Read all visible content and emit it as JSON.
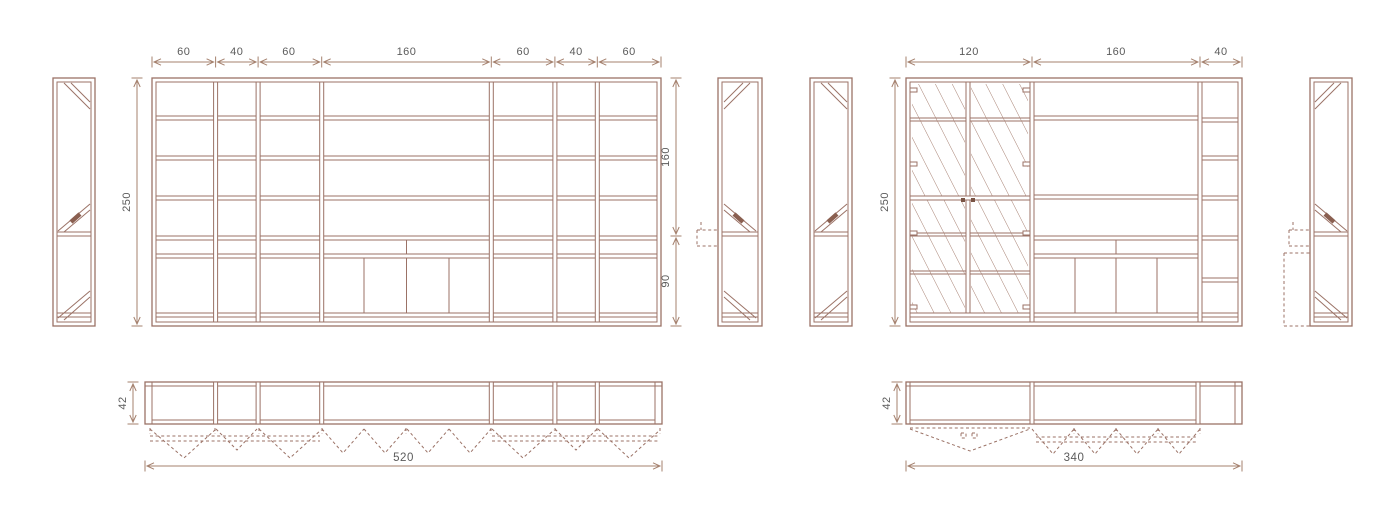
{
  "drawing": {
    "colors": {
      "line": "#9b7266",
      "dimension_line": "#a5816e",
      "label_text": "#5b5b5b",
      "background": "#ffffff"
    },
    "left_unit": {
      "front": {
        "width_dims": [
          "60",
          "40",
          "60",
          "160",
          "60",
          "40",
          "60"
        ],
        "height_dim": "250",
        "upper_section_dim": "160",
        "lower_section_dim": "90"
      },
      "plan": {
        "depth_dim": "42",
        "width_dim": "520"
      }
    },
    "right_unit": {
      "front": {
        "width_dims": [
          "120",
          "160",
          "40"
        ],
        "height_dim": "250"
      },
      "plan": {
        "depth_dim": "42",
        "width_dim": "340"
      }
    }
  }
}
